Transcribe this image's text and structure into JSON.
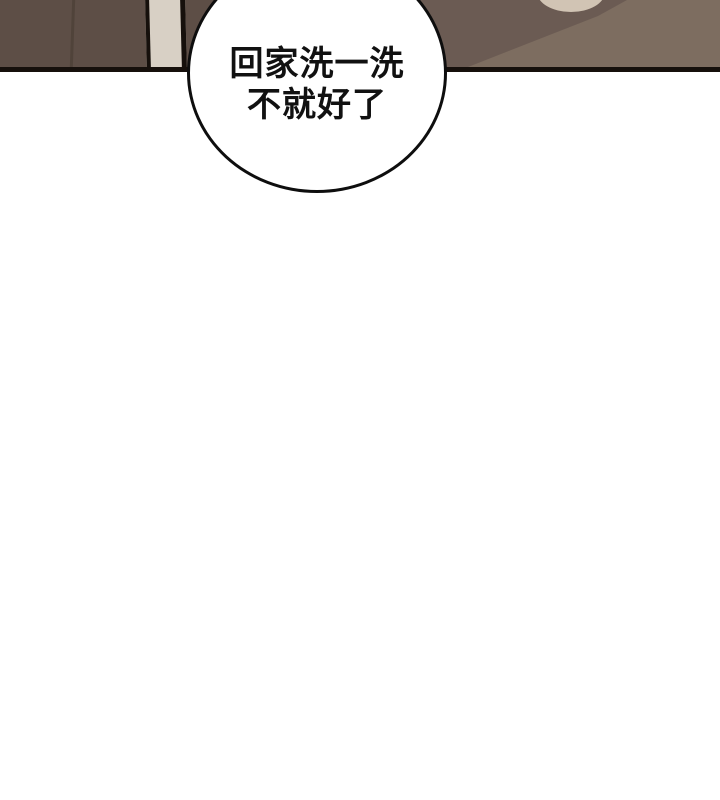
{
  "comic": {
    "speech_bubble": {
      "text_line1": "回家洗一洗",
      "text_line2": "不就好了"
    },
    "colors": {
      "page_background": "#ffffff",
      "bubble_fill": "#ffffff",
      "bubble_outline": "#0e0e0e",
      "text_color": "#111111",
      "panel_outline": "#16100c",
      "wall_dark_brown": "#5d4e46",
      "wall_seam_shadow": "#463a31",
      "door_frame_beige": "#d8d0c5",
      "floor_light_brown": "#7d6d60",
      "floor_shadow_brown": "#6b5b53",
      "cream_object": "#d1c4b4"
    }
  }
}
